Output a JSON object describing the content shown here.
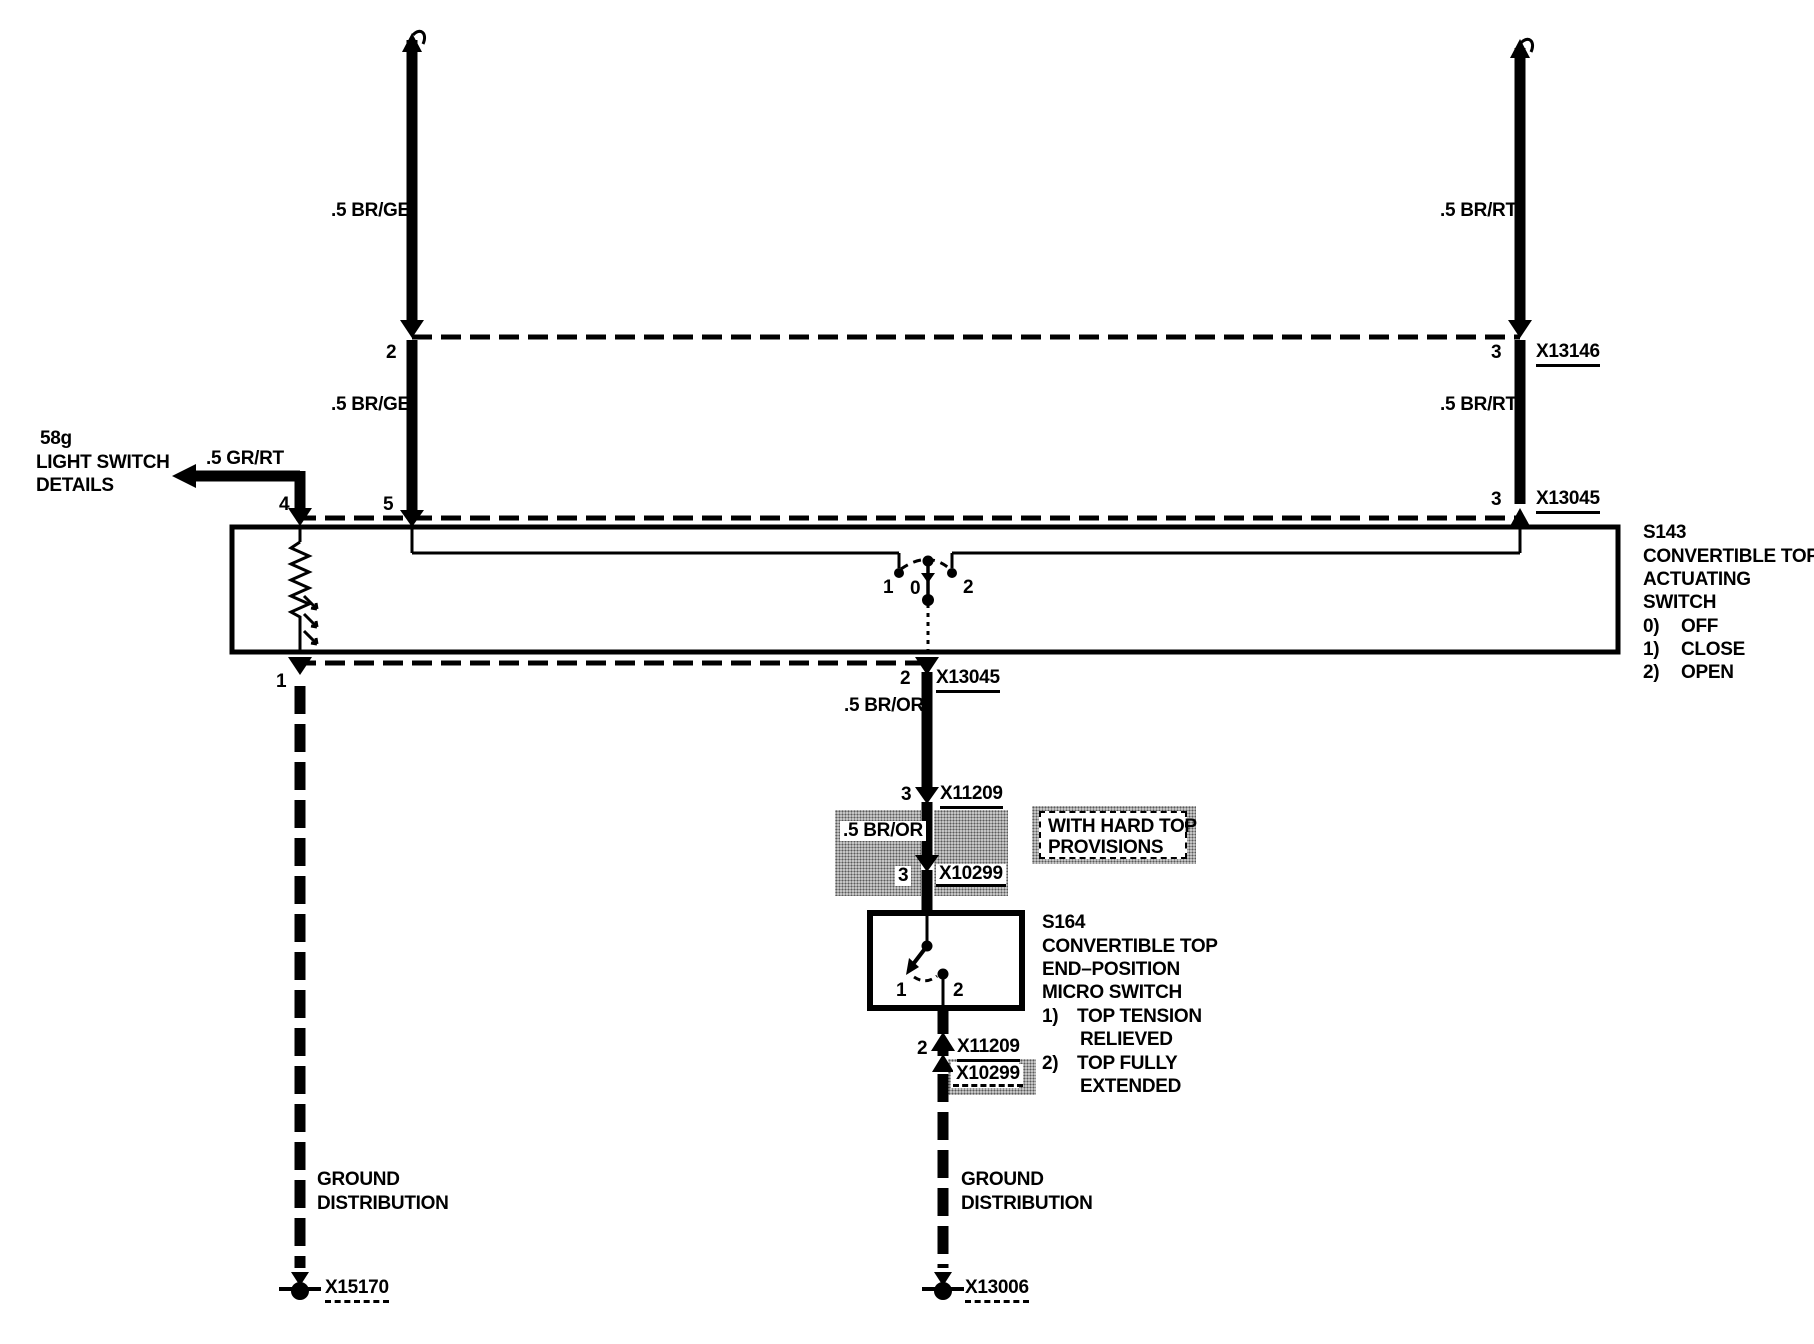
{
  "colors": {
    "ink": "#000000",
    "paper": "#ffffff",
    "stipple_gray": "#c9c9c9"
  },
  "notes": {
    "light_switch": {
      "code": "58g",
      "line1": "LIGHT SWITCH",
      "line2": "DETAILS"
    },
    "hard_top": {
      "line1": "WITH HARD TOP",
      "line2": "PROVISIONS"
    },
    "ground": {
      "line1": "GROUND",
      "line2": "DISTRIBUTION"
    }
  },
  "wire_labels": {
    "gr_rt": ".5 GR/RT",
    "br_ge": ".5 BR/GE",
    "br_rt": ".5 BR/RT",
    "br_or": ".5 BR/OR"
  },
  "connectors": {
    "x13146": "X13146",
    "x13045": "X13045",
    "x11209": "X11209",
    "x10299": "X10299",
    "x15170": "X15170",
    "x13006": "X13006"
  },
  "pins": {
    "n0": "0",
    "n1": "1",
    "n2": "2",
    "n3": "3",
    "n4": "4",
    "n5": "5"
  },
  "s143": {
    "code": "S143",
    "name1": "CONVERTIBLE TOP",
    "name2": "ACTUATING",
    "name3": "SWITCH",
    "positions": [
      {
        "n": "0)",
        "label": "OFF"
      },
      {
        "n": "1)",
        "label": "CLOSE"
      },
      {
        "n": "2)",
        "label": "OPEN"
      }
    ]
  },
  "s164": {
    "code": "S164",
    "name1": "CONVERTIBLE TOP",
    "name2": "END–POSITION",
    "name3": "MICRO SWITCH",
    "positions": [
      {
        "n": "1)",
        "line1": "TOP TENSION",
        "line2": "RELIEVED"
      },
      {
        "n": "2)",
        "line1": "TOP FULLY",
        "line2": "EXTENDED"
      }
    ]
  }
}
